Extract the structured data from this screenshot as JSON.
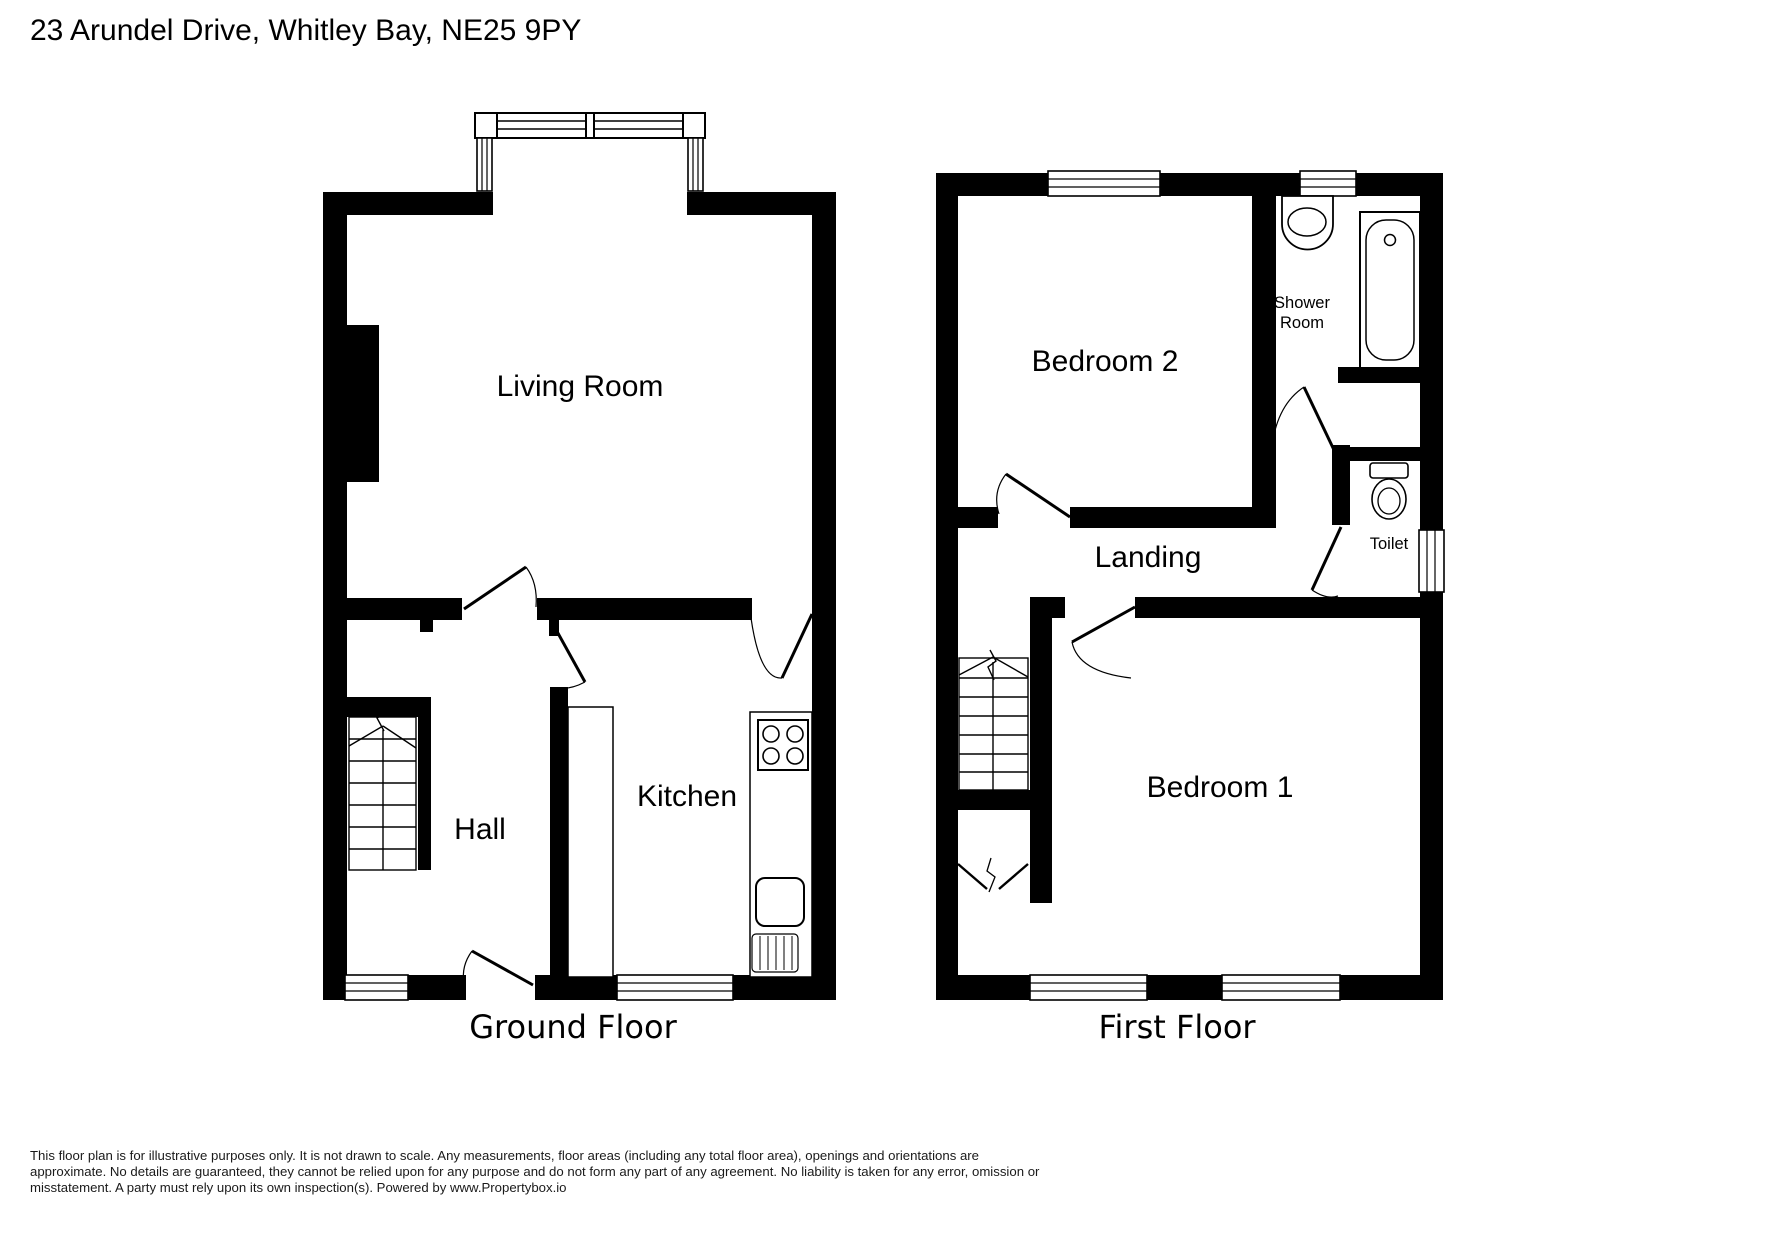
{
  "title": "23 Arundel Drive, Whitley Bay, NE25 9PY",
  "colors": {
    "walls": "#000000",
    "background": "#ffffff",
    "lines": "#000000"
  },
  "ground_floor": {
    "label": "Ground Floor",
    "rooms": {
      "living_room": "Living Room",
      "hall": "Hall",
      "kitchen": "Kitchen"
    }
  },
  "first_floor": {
    "label": "First Floor",
    "rooms": {
      "bedroom2": "Bedroom 2",
      "shower_room_line1": "Shower",
      "shower_room_line2": "Room",
      "landing": "Landing",
      "toilet": "Toilet",
      "bedroom1": "Bedroom 1"
    }
  },
  "disclaimer": {
    "lines": [
      "This floor plan is for illustrative purposes only. It is not drawn to scale. Any measurements, floor areas (including any total floor area), openings and orientations are",
      "approximate. No details are guaranteed, they cannot be relied upon for any purpose and do not form any part of any agreement. No liability is taken for any error, omission or",
      "misstatement. A party must rely upon its own inspection(s). Powered by www.Propertybox.io"
    ]
  }
}
